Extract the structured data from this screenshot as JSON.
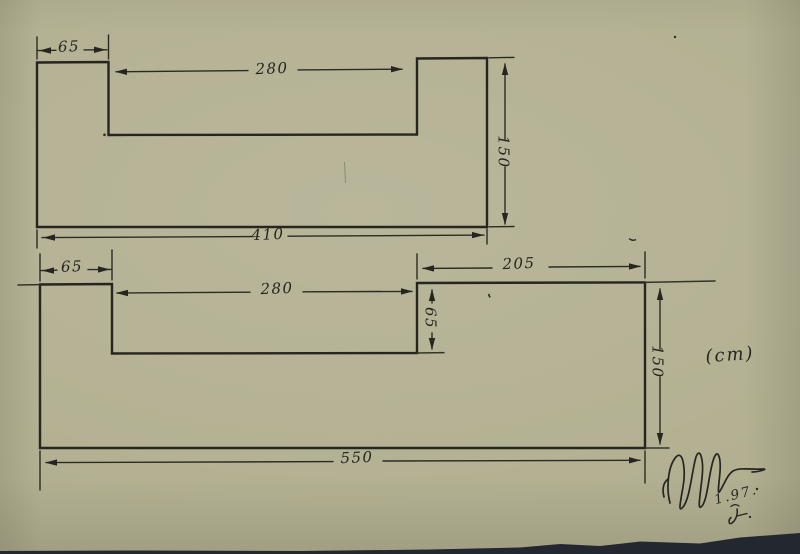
{
  "drawing": {
    "unit_label": "(cm)",
    "top_shape": {
      "tab_width": "65",
      "notch_width": "280",
      "height": "150",
      "total_width": "410"
    },
    "bottom_shape": {
      "tab_width": "65",
      "notch_width": "280",
      "notch_depth": "65",
      "right_width": "205",
      "height": "150",
      "total_width": "550"
    },
    "signature": {
      "date": "1.97."
    }
  }
}
